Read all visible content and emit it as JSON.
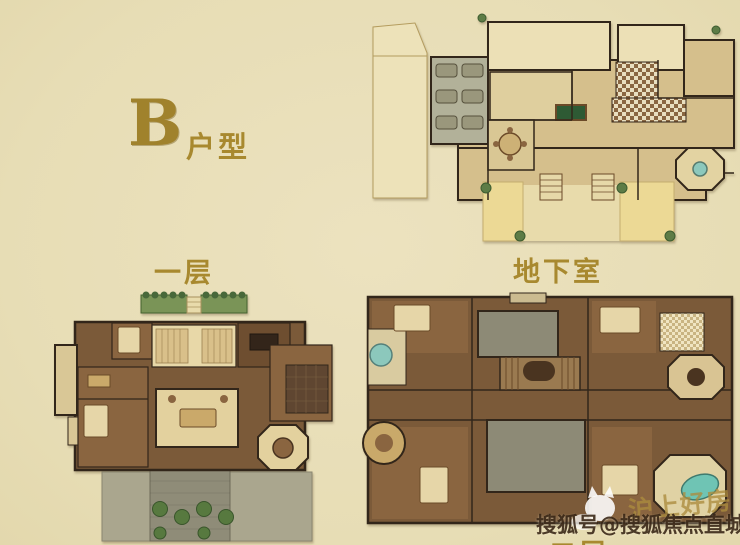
{
  "page": {
    "background_color": "#e9dfba"
  },
  "title": {
    "unit_letter": "B",
    "unit_suffix": "户型"
  },
  "floor_labels": {
    "first": "一层",
    "basement": "地下室",
    "second": "二层"
  },
  "watermark": {
    "brand": "沪上好房",
    "account": "搜狐号@搜狐焦点直城站",
    "icon": "sohu-fox-mascot"
  },
  "colors": {
    "label_gold": "#a8892f",
    "wall_dark": "#32261a",
    "room_tan": "#d5bf8c",
    "floor_brown": "#7b5a39",
    "garage_gray": "#b2b199",
    "terrace_gray": "#8f8c78",
    "terrace_yellow": "#ecd995",
    "plant_green": "#5d7c46",
    "pool_teal": "#6fc4b4",
    "watermark_dark": "#342212"
  }
}
